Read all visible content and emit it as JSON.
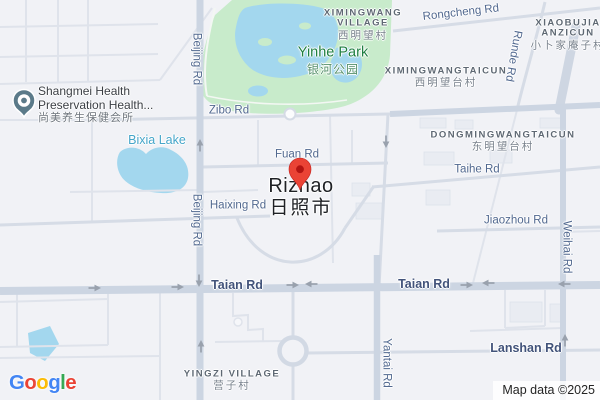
{
  "city": {
    "name": "Rizhao",
    "name_zh": "日照市"
  },
  "poi": {
    "line1": "Shangmei Health",
    "line2": "Preservation Health...",
    "name_zh": "尚美养生保健会所"
  },
  "park": {
    "name": "Yinhe Park",
    "name_zh": "银河公园"
  },
  "water": {
    "bixia_lake": "Bixia Lake"
  },
  "villages": {
    "ximingwang": {
      "line1": "XIMINGWANG",
      "line2": "VILLAGE",
      "zh": "西明望村"
    },
    "xiaobujia": {
      "line1": "XIAOBUJIA",
      "line2": "ANZICUN",
      "zh": "小卜家庵子村"
    },
    "ximingwangtaicun": {
      "name": "XIMINGWANGTAICUN",
      "zh": "西明望台村"
    },
    "dongmingwangtaicun": {
      "name": "DONGMINGWANGTAICUN",
      "zh": "东明望台村"
    },
    "yingzi": {
      "name": "YINGZI VILLAGE",
      "zh": "营子村"
    }
  },
  "roads": {
    "beijing": "Beijing Rd",
    "zibo": "Zibo Rd",
    "fuan": "Fuan Rd",
    "haixing": "Haixing Rd",
    "rongcheng": "Rongcheng Rd",
    "runde": "Runde Rd",
    "taihe": "Taihe Rd",
    "jiaozhou": "Jiaozhou Rd",
    "weihai": "Weihai Rd",
    "taian": "Taian Rd",
    "yantai": "Yantai Rd",
    "lanshan": "Lanshan Rd"
  },
  "attribution": {
    "map_data": "Map data ©2025",
    "google_letters": [
      {
        "ch": "G",
        "color": "#4285F4"
      },
      {
        "ch": "o",
        "color": "#EA4335"
      },
      {
        "ch": "o",
        "color": "#FBBC05"
      },
      {
        "ch": "g",
        "color": "#4285F4"
      },
      {
        "ch": "l",
        "color": "#34A853"
      },
      {
        "ch": "e",
        "color": "#EA4335"
      }
    ]
  },
  "colors": {
    "background": "#f1f2f6",
    "water": "#a3d7ee",
    "park": "#c8ebcb",
    "road_major": "#ccd5e2",
    "road_medium": "#d7dde7",
    "road_minor": "#e0e4eb",
    "pin": "#EA4335",
    "pin_dot": "#B31412",
    "poi_marker": "#5b7a89",
    "road_label": "#51688f",
    "water_label": "#45a5c9",
    "park_label": "#1f7f41",
    "village_label": "#5e6873",
    "city_label": "#1f2125"
  }
}
